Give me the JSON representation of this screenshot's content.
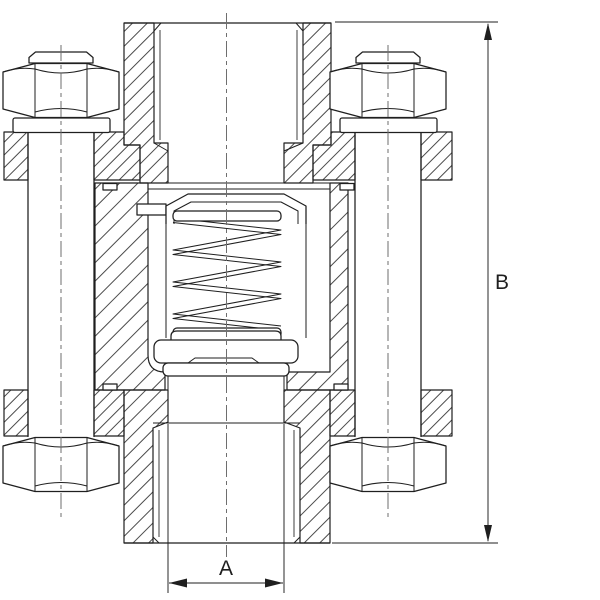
{
  "drawing": {
    "dimension_labels": {
      "width_a": "A",
      "height_b": "B"
    }
  },
  "colors": {
    "line": "#1f1f1f",
    "centerline": "#6e6e6e",
    "background": "#ffffff"
  }
}
